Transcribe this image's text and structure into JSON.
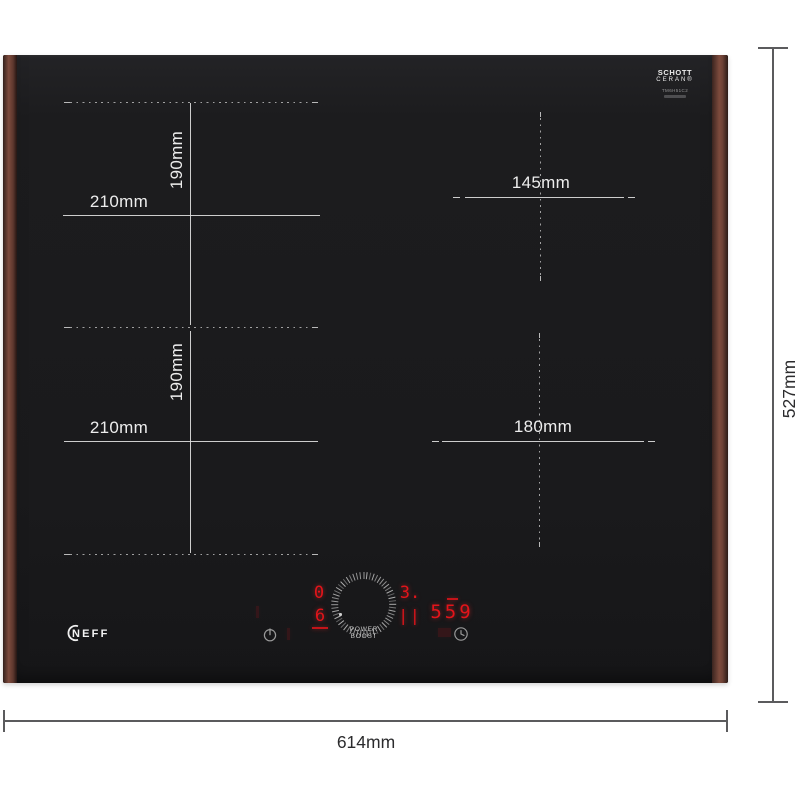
{
  "meta": {
    "description": "NEFF induction hob dimension diagram",
    "background": "#ffffff"
  },
  "colors": {
    "glass_black": "#1a1a1c",
    "wood_trim_brown": "#6e4236",
    "marking_white": "#dcdcdc",
    "display_red": "#e3141a",
    "dimension_gray": "#5b5b5d",
    "label_dark": "#2b2b2d"
  },
  "dimensions": {
    "outer_width": "614mm",
    "outer_depth": "527mm",
    "zones": {
      "top_left": {
        "width": "210mm",
        "depth": "190mm"
      },
      "bottom_left": {
        "width": "210mm",
        "depth": "190mm"
      },
      "top_right": {
        "diameter": "145mm"
      },
      "bottom_right": {
        "diameter": "180mm"
      }
    }
  },
  "branding": {
    "logo": "NEFF",
    "glass_line1": "SCHOTT",
    "glass_line2": "CERAN®",
    "glass_model": "TM6H51C2"
  },
  "control_panel": {
    "zone_left_top": "0",
    "zone_left_bottom": "6",
    "zone_right_top": "3.",
    "zone_right_bottom": "||",
    "timer": "559",
    "boost_line1": "POWER",
    "boost_line2": "BOOST",
    "icons": [
      "power-icon",
      "twist-dial",
      "timer-clock-icon"
    ]
  }
}
